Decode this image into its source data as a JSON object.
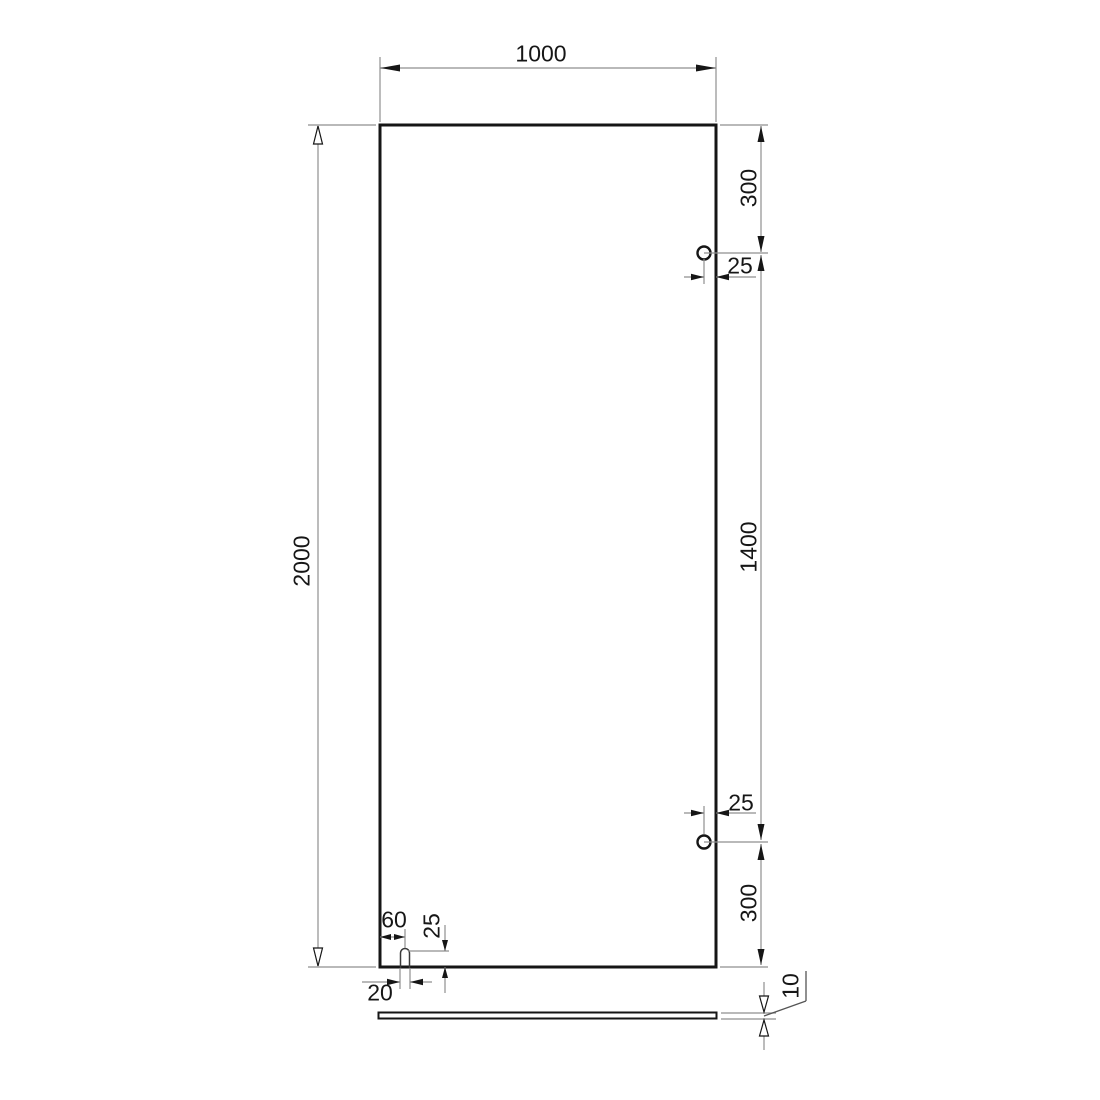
{
  "drawing": {
    "labels": {
      "width": "1000",
      "height": "2000",
      "hole_top_offset": "300",
      "hole_top_edge": "25",
      "hole_spacing": "1400",
      "hole_bottom_edge": "25",
      "hole_bottom_offset": "300",
      "slot_offset": "60",
      "slot_depth": "25",
      "slot_width": "20",
      "thickness": "10"
    },
    "colors": {
      "outline": "#161616",
      "dimension_line": "#8f8f8f",
      "background": "#ffffff"
    }
  }
}
